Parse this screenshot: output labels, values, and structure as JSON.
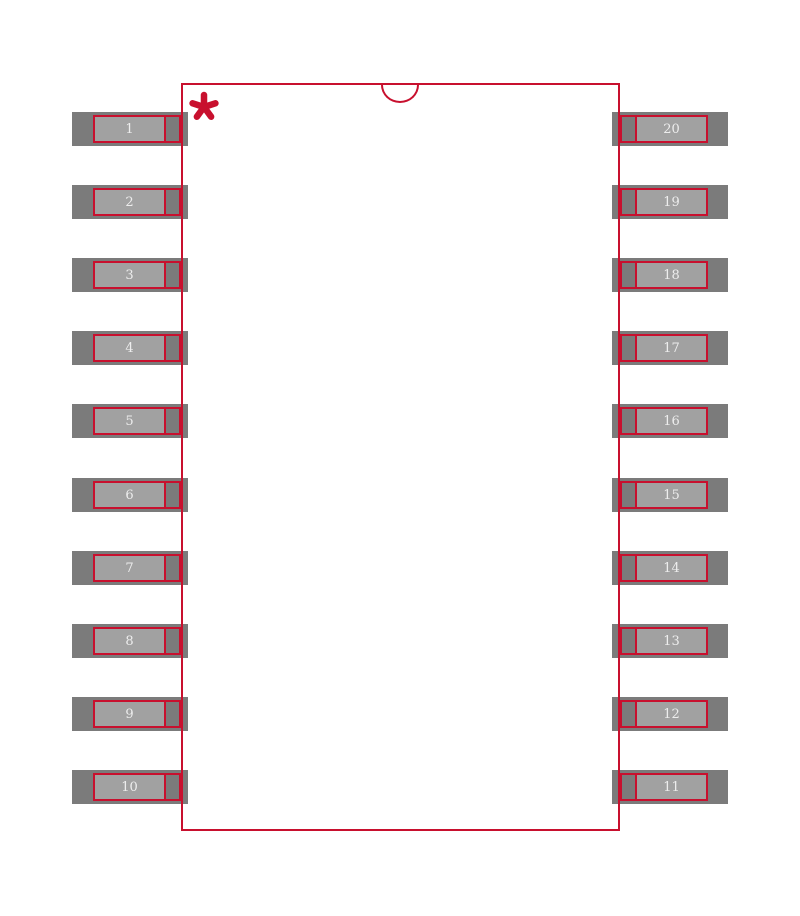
{
  "footprint": {
    "pins_left": [
      "1",
      "2",
      "3",
      "4",
      "5",
      "6",
      "7",
      "8",
      "9",
      "10"
    ],
    "pins_right": [
      "20",
      "19",
      "18",
      "17",
      "16",
      "15",
      "14",
      "13",
      "12",
      "11"
    ],
    "marker_glyph": "*",
    "colors": {
      "outline_red": "#c8102e",
      "pad_dark": "#7b7b7b",
      "pad_light": "#a1a1a1",
      "number_text": "#ededed",
      "background": "#ffffff"
    }
  }
}
